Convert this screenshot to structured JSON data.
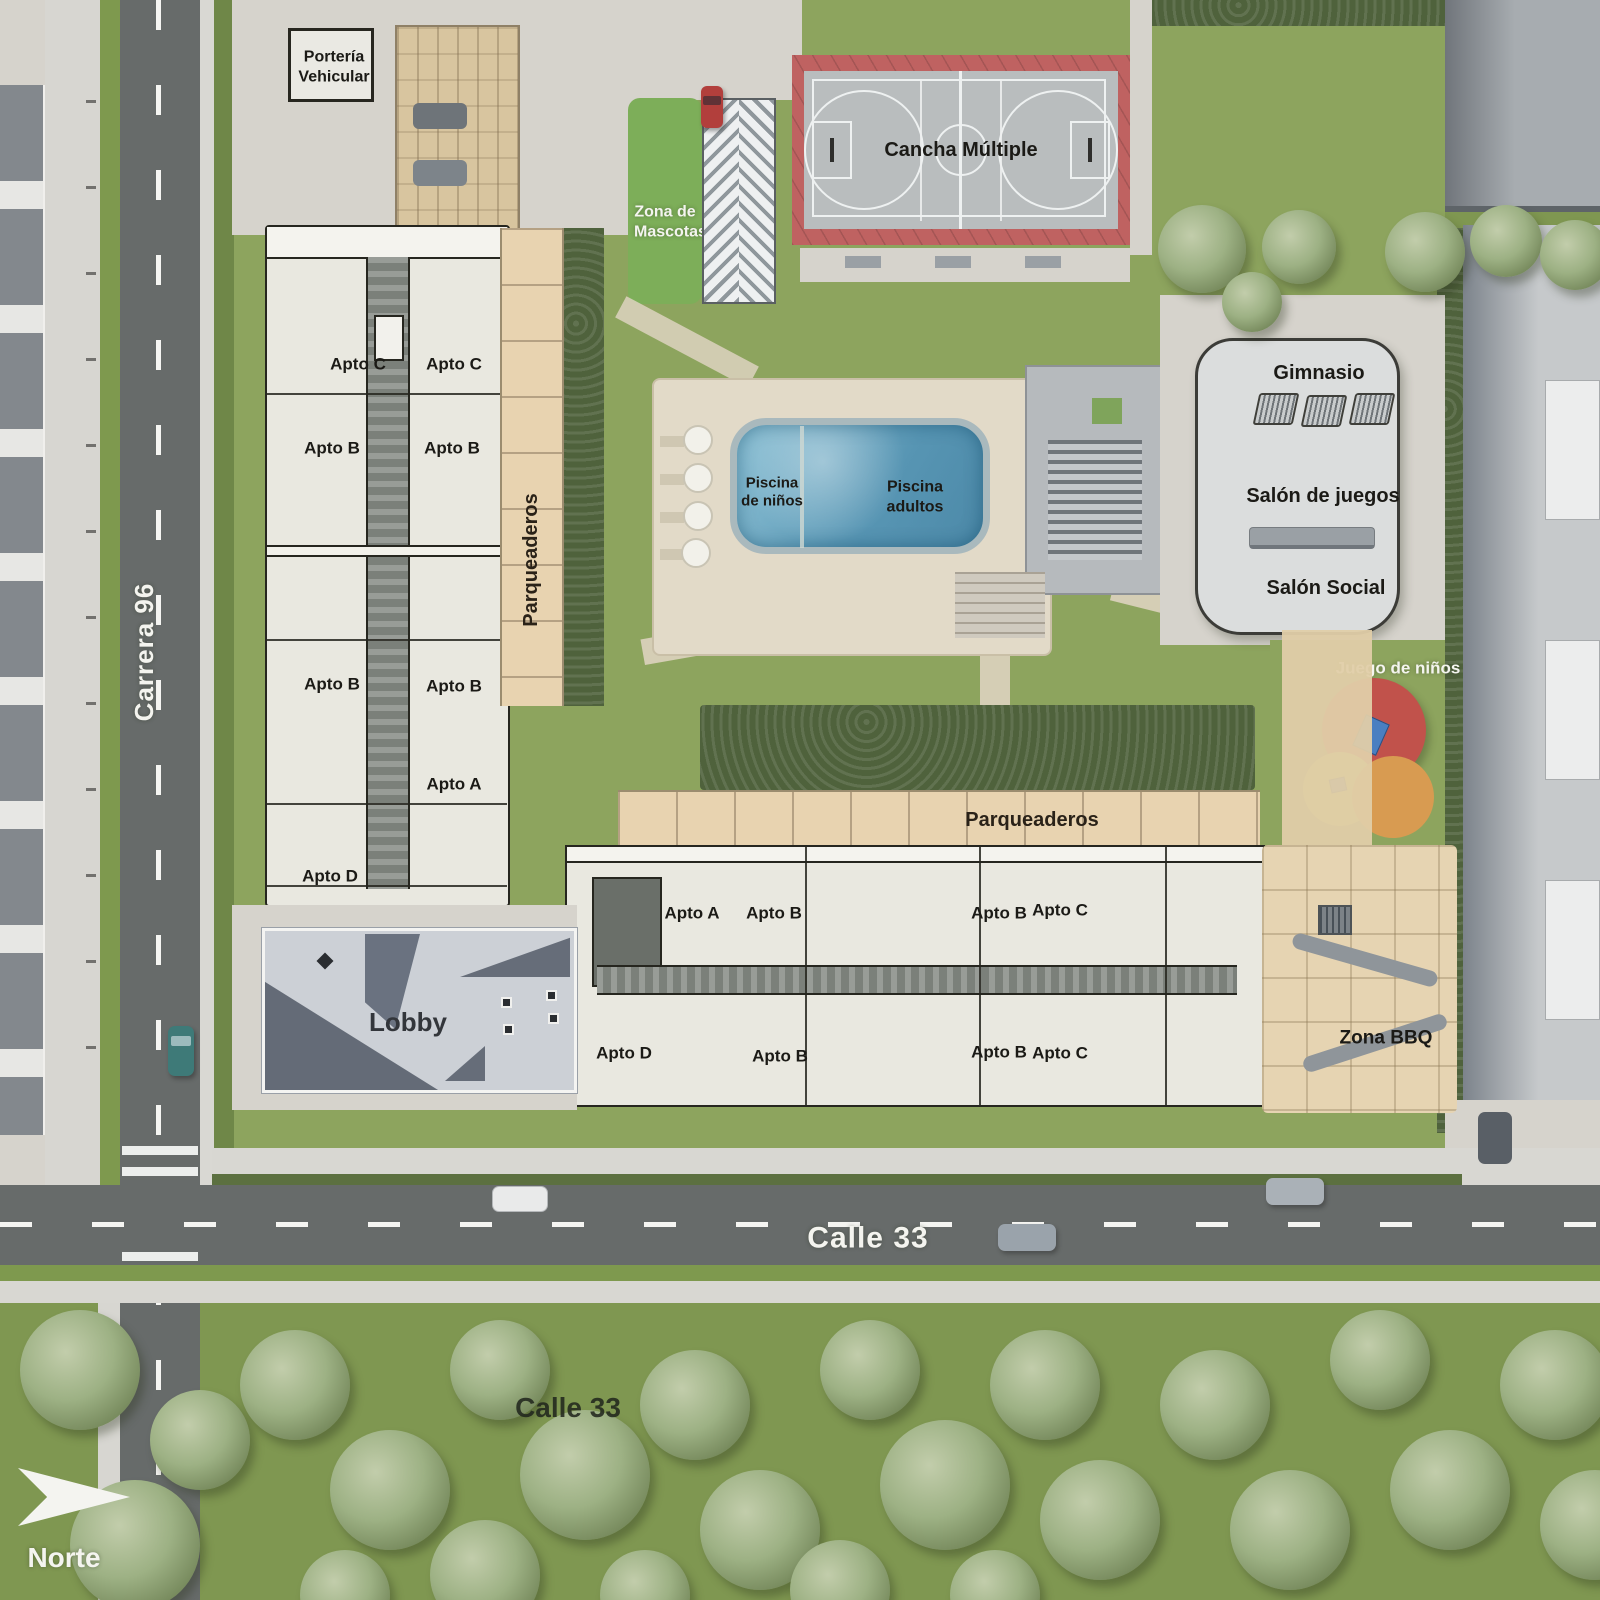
{
  "plan": {
    "streets": {
      "carrera_96": "Carrera 96",
      "calle_33": "Calle 33",
      "calle_33_south": "Calle 33"
    },
    "compass_label": "Norte",
    "entrance_label": "Portería Vehicular",
    "pet_zone_label": "Zona de Mascotas",
    "court_label": "Cancha Múltiple",
    "pool_kids_label": "Piscina de niños",
    "pool_adults_label": "Piscina adultos",
    "gym_label": "Gimnasio",
    "games_room_label": "Salón de juegos",
    "social_room_label": "Salón Social",
    "playground_label": "Juego de niños",
    "bbq_label": "Zona BBQ",
    "lobby_label": "Lobby",
    "parking_west_label": "Parqueaderos",
    "parking_south_label": "Parqueaderos",
    "tower_north_units": [
      "Apto C",
      "Apto C",
      "Apto B",
      "Apto B",
      "Apto B",
      "Apto B",
      "Apto A",
      "Apto D"
    ],
    "tower_south_units_top": [
      "Apto A",
      "Apto B",
      "Apto B",
      "Apto C"
    ],
    "tower_south_units_bottom": [
      "Apto D",
      "Apto B",
      "Apto B",
      "Apto C"
    ],
    "colors": {
      "grass": "#8da45e",
      "asphalt": "#676b6a",
      "court_red": "#bf6261",
      "pool_water": "#5e9cb8",
      "paving_tan": "#e8d3b0",
      "playground_red": "#c1524b",
      "playground_yellow": "#c6cb61",
      "playground_orange": "#d89b51"
    }
  }
}
